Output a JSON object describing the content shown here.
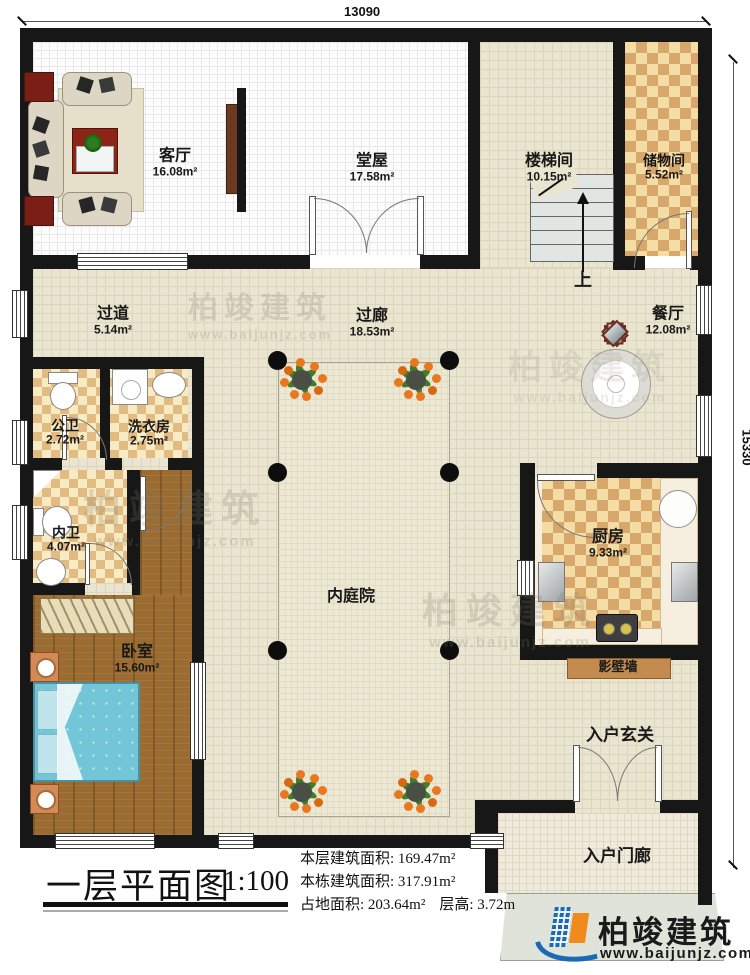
{
  "dims": {
    "top": "13090",
    "right": "15330"
  },
  "rooms": {
    "living": {
      "name": "客厅",
      "area": "16.08m²"
    },
    "hall": {
      "name": "堂屋",
      "area": "17.58m²"
    },
    "stairroom": {
      "name": "楼梯间",
      "area": "10.15m²"
    },
    "storage": {
      "name": "储物间",
      "area": "5.52m²"
    },
    "corridor": {
      "name": "过道",
      "area": "5.14m²"
    },
    "gallery": {
      "name": "过廊",
      "area": "18.53m²"
    },
    "dining": {
      "name": "餐厅",
      "area": "12.08m²"
    },
    "public_bath": {
      "name": "公卫",
      "area": "2.72m²"
    },
    "laundry": {
      "name": "洗衣房",
      "area": "2.75m²"
    },
    "inner_bath": {
      "name": "内卫",
      "area": "4.07m²"
    },
    "kitchen": {
      "name": "厨房",
      "area": "9.33m²"
    },
    "bedroom": {
      "name": "卧室",
      "area": "15.60m²"
    },
    "courtyard": {
      "name": "内庭院"
    },
    "screen_wall": {
      "name": "影壁墙"
    },
    "entry_foyer": {
      "name": "入户玄关"
    },
    "entry_porch": {
      "name": "入户门廊"
    }
  },
  "stair_up": "上",
  "title": {
    "name": "一层平面图",
    "scale": "1:100"
  },
  "stats": {
    "line1": "本层建筑面积: 169.47m²",
    "line2": "本栋建筑面积: 317.91m²",
    "line3a": "占地面积: 203.64m²",
    "line3b": "层高: 3.72m"
  },
  "watermark": {
    "text": "柏竣建筑",
    "url": "www.baijunjz.com"
  },
  "logo": {
    "text": "柏竣建筑",
    "url": "www.baijunjz.com"
  },
  "colors": {
    "wall": "#171717",
    "floor_beige": "#eae5d1",
    "logo_blue": "#1b6ab5",
    "logo_orange": "#f08a1d"
  }
}
